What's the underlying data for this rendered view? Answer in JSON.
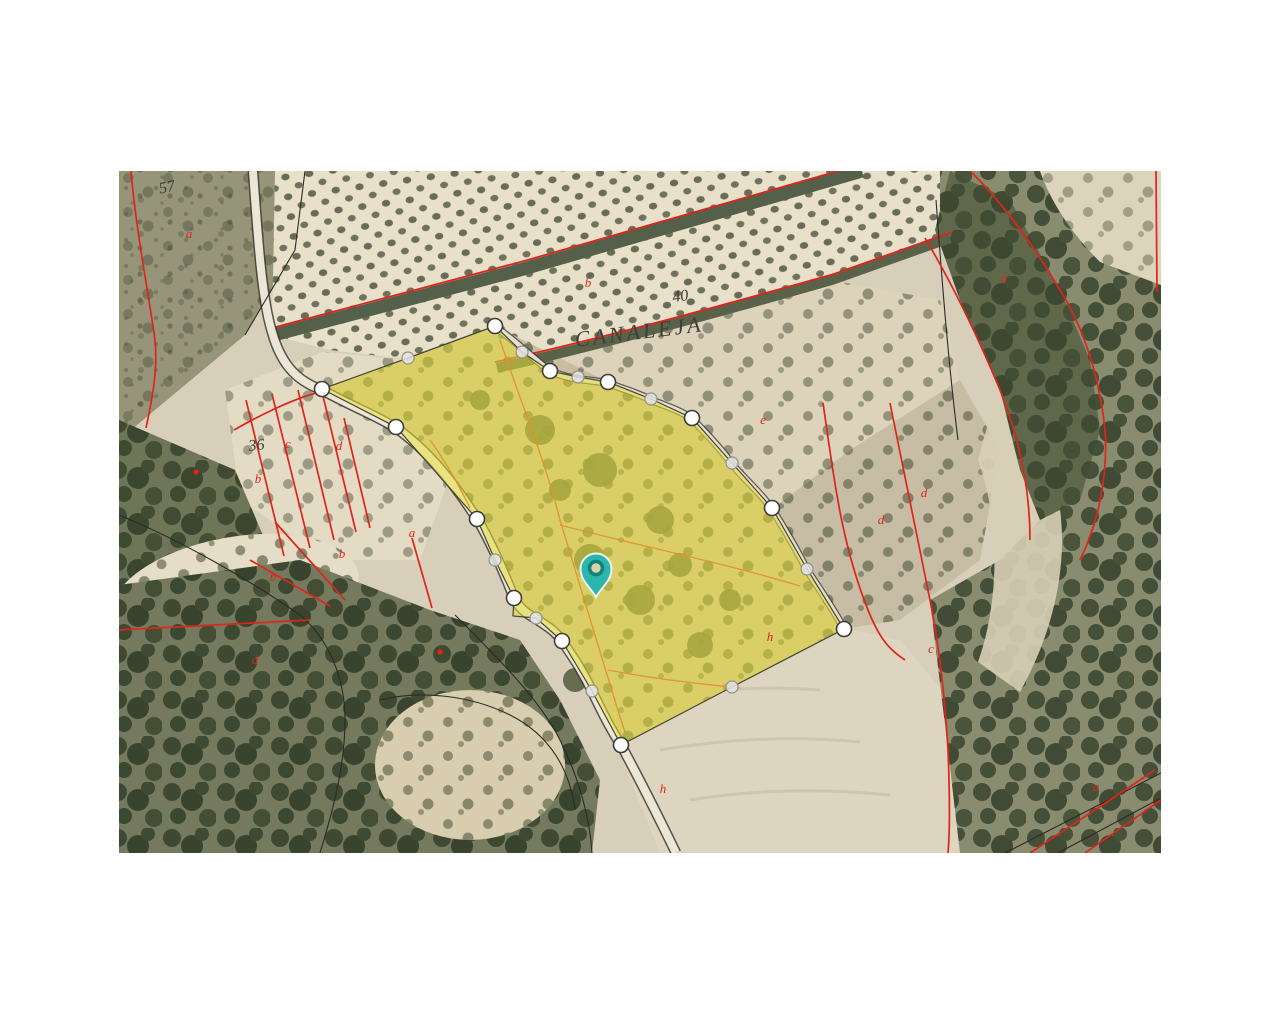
{
  "page": {
    "background": "#ffffff"
  },
  "map": {
    "region_label": "CANALEJA",
    "area": {
      "x": 119,
      "y": 171,
      "w": 1042,
      "h": 682
    },
    "colors": {
      "parcel_fill": "#e8df3a",
      "parcel_fill_opacity": "0.55",
      "parcel_stroke": "#44443a",
      "vertex_major_fill": "#ffffff",
      "vertex_major_stroke": "#3c3c3c",
      "vertex_minor_fill": "#e3e3e3",
      "vertex_minor_stroke": "#8f8f8f",
      "cadastral_red": "#e0241c",
      "subparcel_orange": "#e2902f",
      "pin_fill": "#2cb5ad",
      "pin_ring": "#13807a",
      "pin_outline": "#eaf6ef",
      "label_dark": "#3b3b31"
    },
    "pin": {
      "x": 596,
      "y": 597
    },
    "parcel": {
      "ring": [
        [
          495,
          326
        ],
        [
          522,
          352
        ],
        [
          550,
          371
        ],
        [
          578,
          377
        ],
        [
          608,
          382
        ],
        [
          651,
          399
        ],
        [
          692,
          418
        ],
        [
          732,
          463
        ],
        [
          772,
          508
        ],
        [
          807,
          569
        ],
        [
          844,
          629
        ],
        [
          732,
          687
        ],
        [
          621,
          745
        ],
        [
          592,
          691
        ],
        [
          562,
          641
        ],
        [
          536,
          618
        ],
        [
          513,
          616
        ],
        [
          514,
          598
        ],
        [
          495,
          560
        ],
        [
          477,
          519
        ],
        [
          396,
          427
        ],
        [
          322,
          389
        ],
        [
          408,
          358
        ]
      ],
      "vertices_major": [
        [
          495,
          326
        ],
        [
          550,
          371
        ],
        [
          608,
          382
        ],
        [
          692,
          418
        ],
        [
          772,
          508
        ],
        [
          844,
          629
        ],
        [
          621,
          745
        ],
        [
          562,
          641
        ],
        [
          514,
          598
        ],
        [
          477,
          519
        ],
        [
          396,
          427
        ],
        [
          322,
          389
        ]
      ],
      "vertices_minor": [
        [
          522,
          352
        ],
        [
          578,
          377
        ],
        [
          651,
          399
        ],
        [
          732,
          463
        ],
        [
          807,
          569
        ],
        [
          732,
          687
        ],
        [
          592,
          691
        ],
        [
          536,
          618
        ],
        [
          495,
          560
        ],
        [
          408,
          358
        ]
      ]
    },
    "labels": [
      {
        "text": "57",
        "x": 168,
        "y": 192,
        "kind": "dark",
        "rot": -12
      },
      {
        "text": "40",
        "x": 681,
        "y": 301,
        "kind": "dark",
        "rot": -8
      },
      {
        "text": "CANALEJA",
        "x": 640,
        "y": 339,
        "kind": "title",
        "rot": -7
      },
      {
        "text": "36",
        "x": 257,
        "y": 450,
        "kind": "dark",
        "rot": -6
      },
      {
        "text": "a",
        "x": 189,
        "y": 238,
        "kind": "red",
        "rot": 0
      },
      {
        "text": "b",
        "x": 588,
        "y": 287,
        "kind": "red",
        "rot": 0
      },
      {
        "text": "c",
        "x": 288,
        "y": 448,
        "kind": "red",
        "rot": 0
      },
      {
        "text": "d",
        "x": 339,
        "y": 450,
        "kind": "red",
        "rot": 0
      },
      {
        "text": "b",
        "x": 258,
        "y": 483,
        "kind": "red",
        "rot": 0
      },
      {
        "text": "a",
        "x": 412,
        "y": 537,
        "kind": "red",
        "rot": 0
      },
      {
        "text": "b",
        "x": 342,
        "y": 558,
        "kind": "red",
        "rot": 0
      },
      {
        "text": "b",
        "x": 273,
        "y": 581,
        "kind": "red",
        "rot": 0
      },
      {
        "text": "d",
        "x": 255,
        "y": 664,
        "kind": "red",
        "rot": 0
      },
      {
        "text": "d",
        "x": 881,
        "y": 524,
        "kind": "red",
        "rot": 0
      },
      {
        "text": "d",
        "x": 924,
        "y": 497,
        "kind": "red",
        "rot": 0
      },
      {
        "text": "e",
        "x": 763,
        "y": 424,
        "kind": "red",
        "rot": 0
      },
      {
        "text": "c",
        "x": 931,
        "y": 653,
        "kind": "red",
        "rot": 0
      },
      {
        "text": "h",
        "x": 663,
        "y": 793,
        "kind": "red",
        "rot": 0
      },
      {
        "text": "h",
        "x": 770,
        "y": 641,
        "kind": "red",
        "rot": 0
      },
      {
        "text": "a",
        "x": 1004,
        "y": 282,
        "kind": "red",
        "rot": 0
      },
      {
        "text": "a",
        "x": 1096,
        "y": 791,
        "kind": "red",
        "rot": 0
      }
    ],
    "dots": [
      [
        440,
        652
      ],
      [
        196,
        472
      ]
    ]
  }
}
